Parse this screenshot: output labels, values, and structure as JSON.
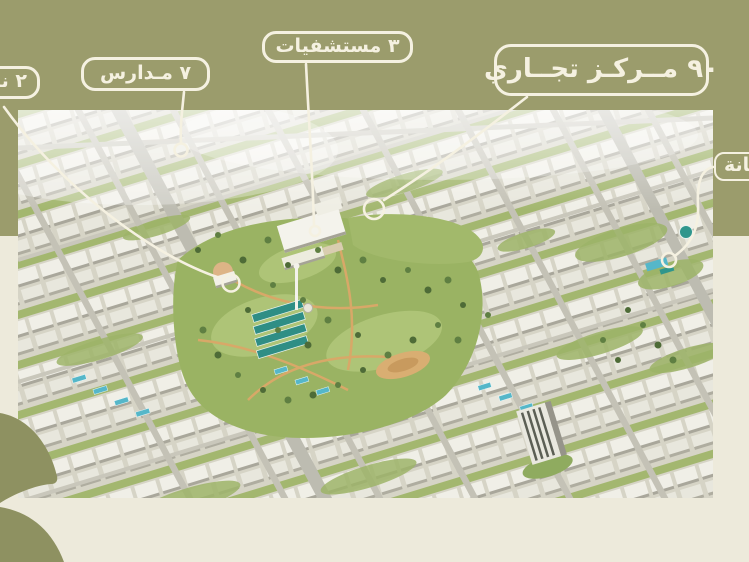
{
  "theme": {
    "band_color": "#9b9c6c",
    "page_background": "#edeadb",
    "callout_color": "#f5f1e1",
    "logo_shape_color": "#8e9161"
  },
  "callouts": {
    "clubs": {
      "label": "٢ نادي"
    },
    "schools": {
      "label": "٧ مـدارس"
    },
    "hospitals": {
      "label": "٣ مستشفيات"
    },
    "commercial": {
      "label": "٩٠ مــركـز تجــاري"
    },
    "nursery": {
      "label": "حضانة"
    }
  }
}
